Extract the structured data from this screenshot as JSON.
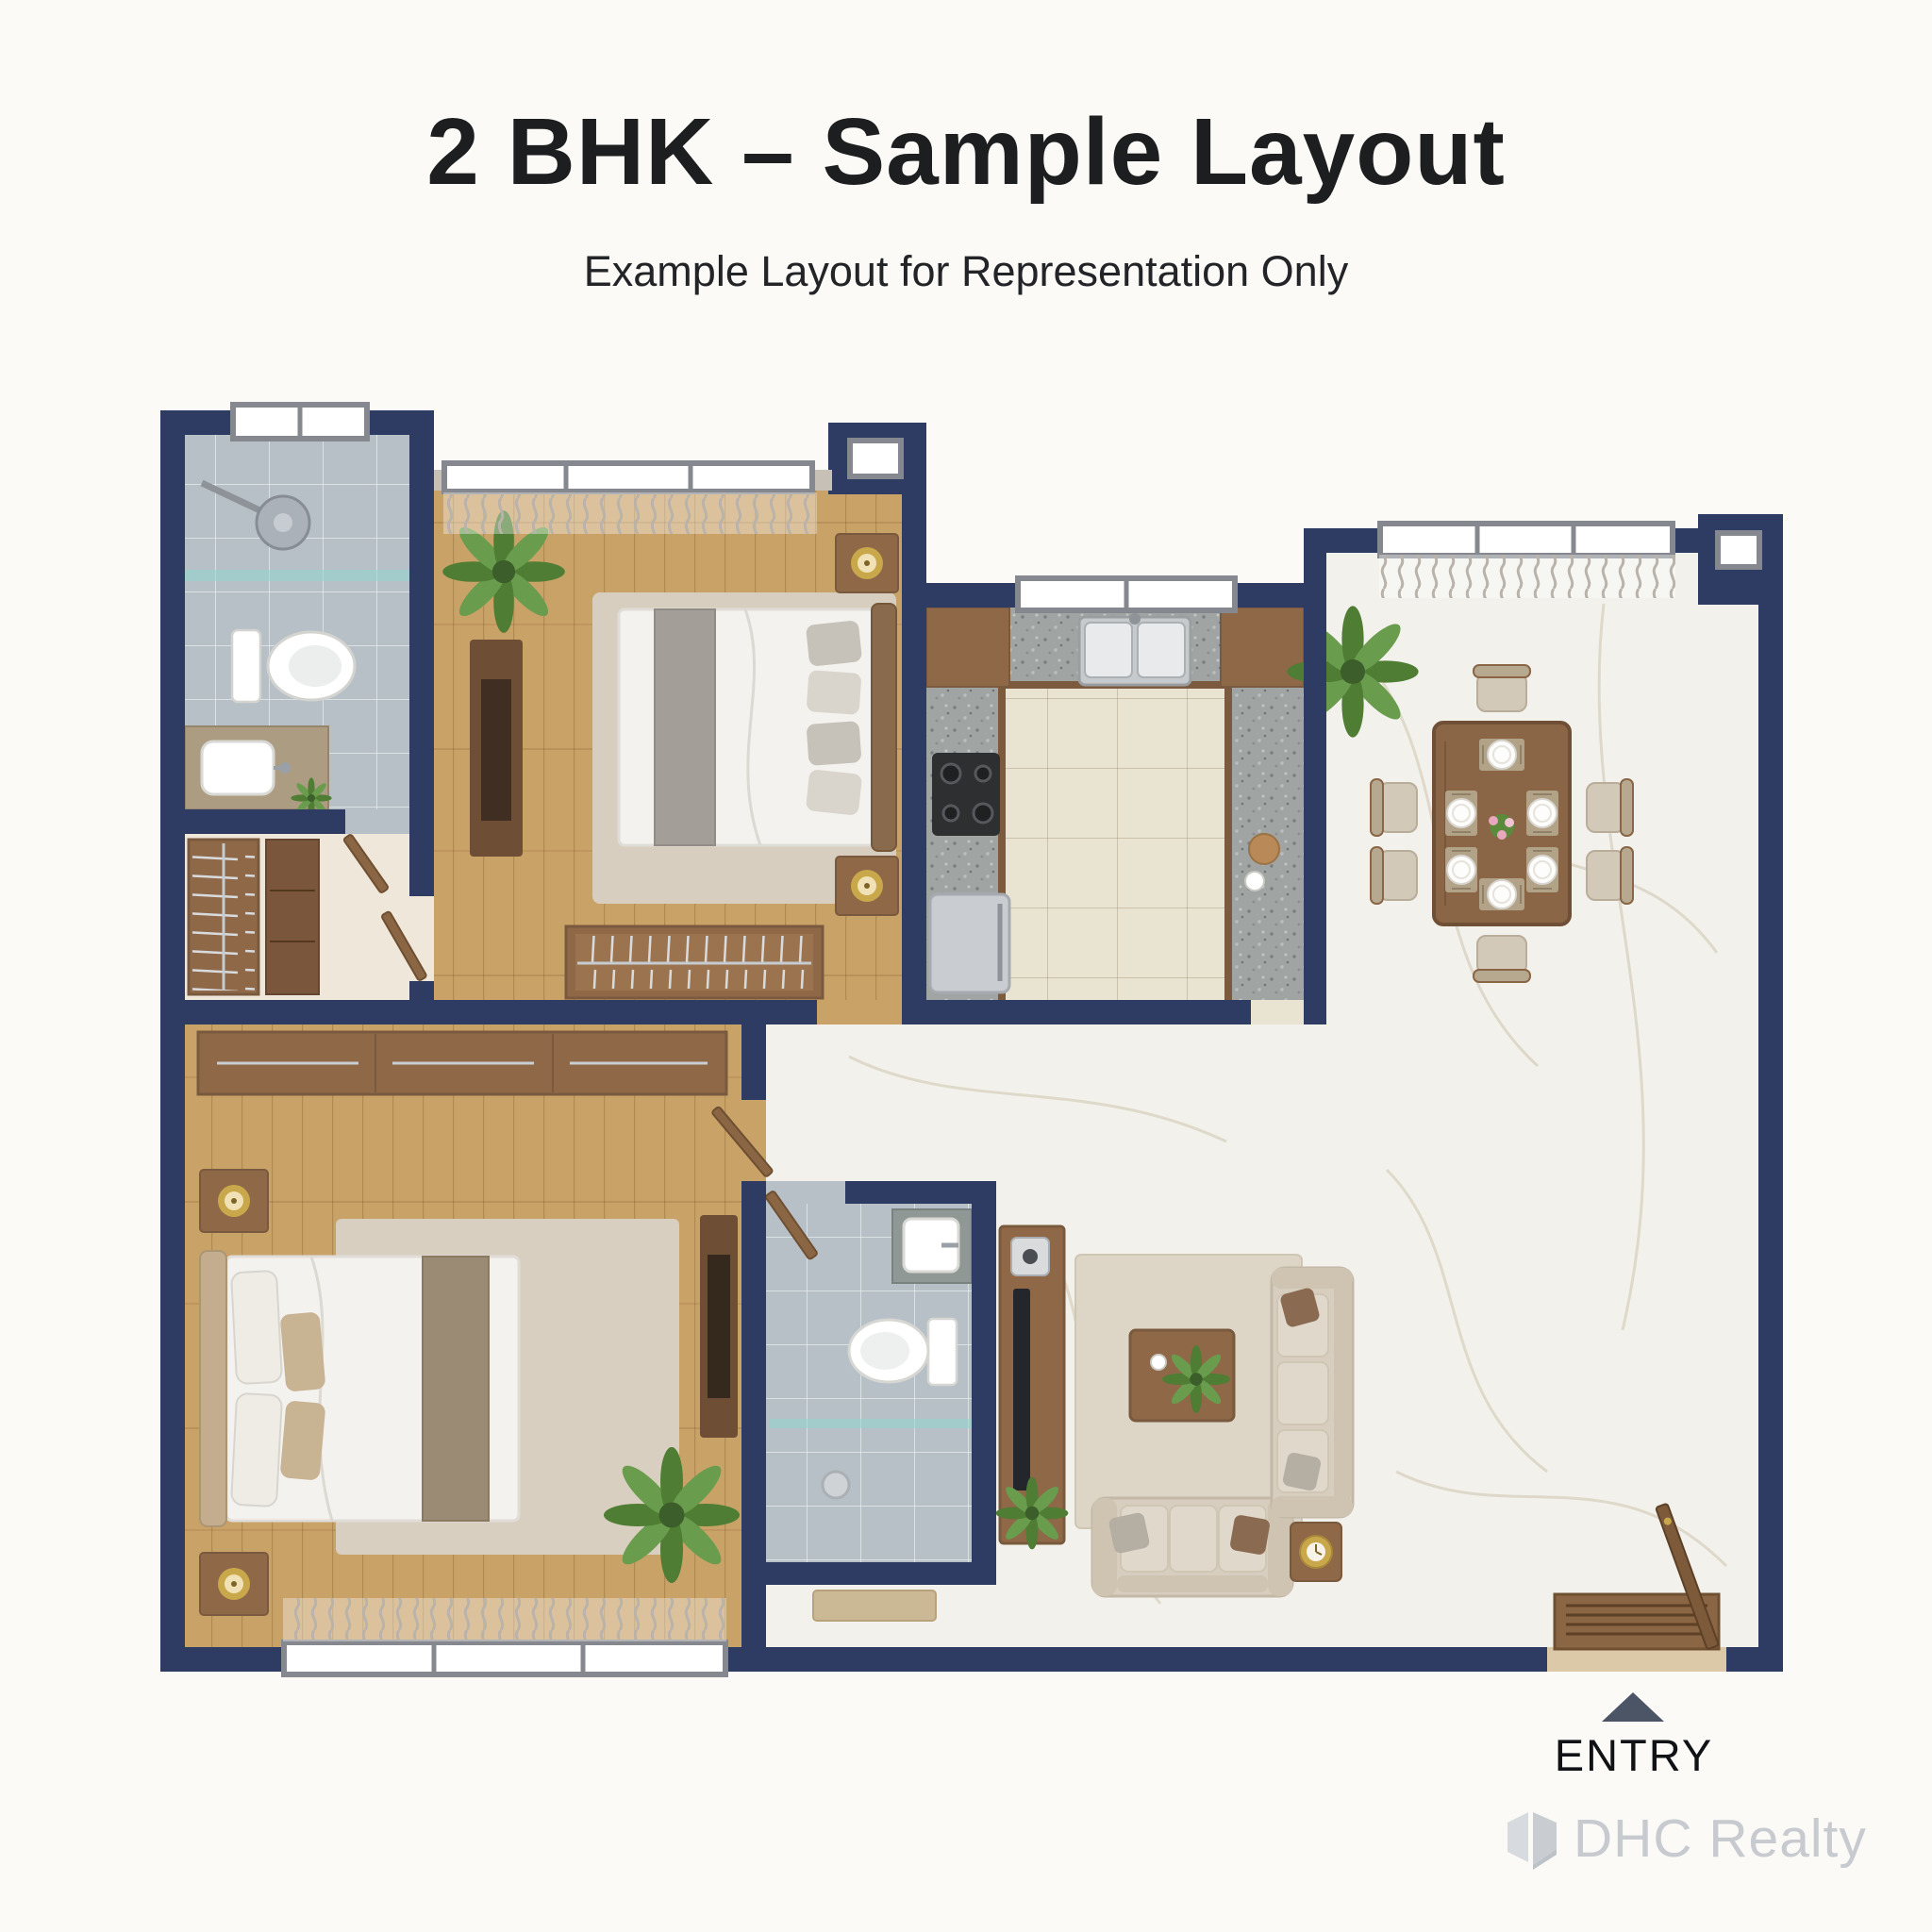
{
  "page": {
    "background": "#fbfaf7",
    "title": "2 BHK – Sample Layout",
    "subtitle": "Example Layout for Representation Only"
  },
  "entry": {
    "label": "ENTRY",
    "arrow": "up-triangle"
  },
  "watermark": {
    "brand": "DHC Realty",
    "icon": "house-cube-icon"
  },
  "palette": {
    "wall": "#2e3c63",
    "floor_wood": "#c9a267",
    "floor_marble": "#f2f1ec",
    "floor_tile_bath": "#b7c0c6",
    "floor_tile_kitchen": "#e9e3d2",
    "counter_granite": "#a0a5a3",
    "cabinet_wood": "#8f6848",
    "furniture_wood_dark": "#6e4f36",
    "fabric_beige": "#d8cec0",
    "bedding_white": "#f4f2ee",
    "accent_gold": "#c9a84c",
    "glass_teal": "#8fd6cf",
    "curtain_grey": "#c3beb5",
    "text_dark": "#1d1e20",
    "watermark_grey": "#c7cacf",
    "entry_arrow": "#4b5566"
  },
  "rooms": [
    {
      "id": "bathroom-1",
      "area": "top-left",
      "features": [
        "shower-head",
        "glass-partition",
        "toilet",
        "vanity-sink",
        "window"
      ]
    },
    {
      "id": "walk-in-closet",
      "area": "left",
      "features": [
        "open-hanger-wardrobe",
        "drawer-unit"
      ]
    },
    {
      "id": "bedroom-1",
      "area": "top-center",
      "features": [
        "double-bed",
        "rug",
        "two-nightstands",
        "gold-table-lamps",
        "dresser",
        "open-hanger-wardrobe",
        "plant",
        "window-curtains"
      ]
    },
    {
      "id": "kitchen",
      "area": "center",
      "features": [
        "u-shaped-granite-counter",
        "double-sink",
        "cooktop",
        "refrigerator",
        "upper-wood-cabinets",
        "window"
      ]
    },
    {
      "id": "dining-area",
      "area": "top-right",
      "features": [
        "six-seater-dining-table",
        "six-plates",
        "flower-centerpiece",
        "plant",
        "window-curtains"
      ]
    },
    {
      "id": "living-room",
      "area": "bottom-right",
      "features": [
        "three-seater-sofa",
        "two-seater-sofa",
        "coffee-table",
        "side-table-gold-clock",
        "rug",
        "tv-console",
        "entry-door",
        "wood-deck"
      ]
    },
    {
      "id": "master-bedroom",
      "area": "bottom-left",
      "features": [
        "double-bed",
        "rug",
        "two-nightstands",
        "gold-table-lamps",
        "long-wardrobe",
        "dresser",
        "plant",
        "window-curtains"
      ]
    },
    {
      "id": "bathroom-2",
      "area": "bottom-center",
      "features": [
        "toilet",
        "counter-sink",
        "glass-shelf",
        "floor-drain",
        "doormat"
      ]
    }
  ]
}
